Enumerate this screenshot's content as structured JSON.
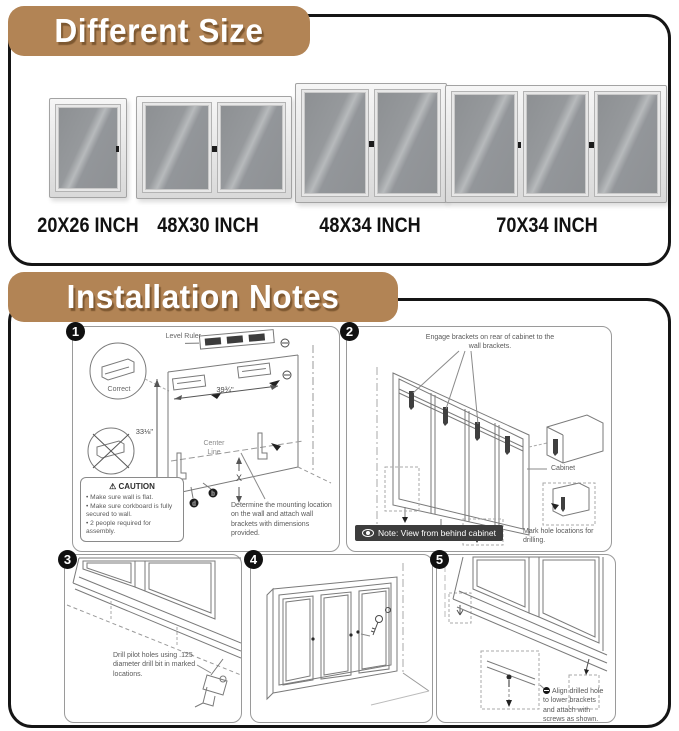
{
  "icons": {
    "warning": "⚠"
  },
  "colors": {
    "banner": "#b28455",
    "note_badge_bg": "#3d3d3d",
    "frame_silver": "#d9d9d9",
    "glass_gray": "#96999c"
  },
  "sections": {
    "different_size": {
      "title": "Different Size",
      "products": [
        {
          "label": "20X26 INCH",
          "doors": 1
        },
        {
          "label": "48X30 INCH",
          "doors": 2
        },
        {
          "label": "48X34 INCH",
          "doors": 2
        },
        {
          "label": "70X34 INCH",
          "doors": 3
        }
      ]
    },
    "installation_notes": {
      "title": "Installation Notes",
      "steps": [
        {
          "number": "1",
          "level_ruler_label": "Level Ruler",
          "correct_label": "Correct",
          "width_dim": "39¾\"",
          "height_dim": "33⅛\"",
          "center_line_label": "Center Line",
          "x_label": "X",
          "fastener_keys": [
            "c",
            "d",
            "b"
          ],
          "caution": {
            "title": "CAUTION",
            "items": [
              "Make sure wall is flat.",
              "Make sure corkboard is fully secured to wall.",
              "2 people required for assembly."
            ]
          },
          "instruction": "Determine the mounting location on the wall and attach wall brackets with dimensions provided."
        },
        {
          "number": "2",
          "instruction": "Engage brackets on rear of cabinet to the wall brackets.",
          "cabinet_label": "Cabinet",
          "mark_label": "Mark hole locations for drilling.",
          "note": "Note: View from behind cabinet"
        },
        {
          "number": "3",
          "instruction": "Drill pilot holes using .125 diameter drill bit in marked locations."
        },
        {
          "number": "4"
        },
        {
          "number": "5",
          "instruction": "Align drilled hole to lower brackets and attach with screws as shown."
        }
      ]
    }
  }
}
